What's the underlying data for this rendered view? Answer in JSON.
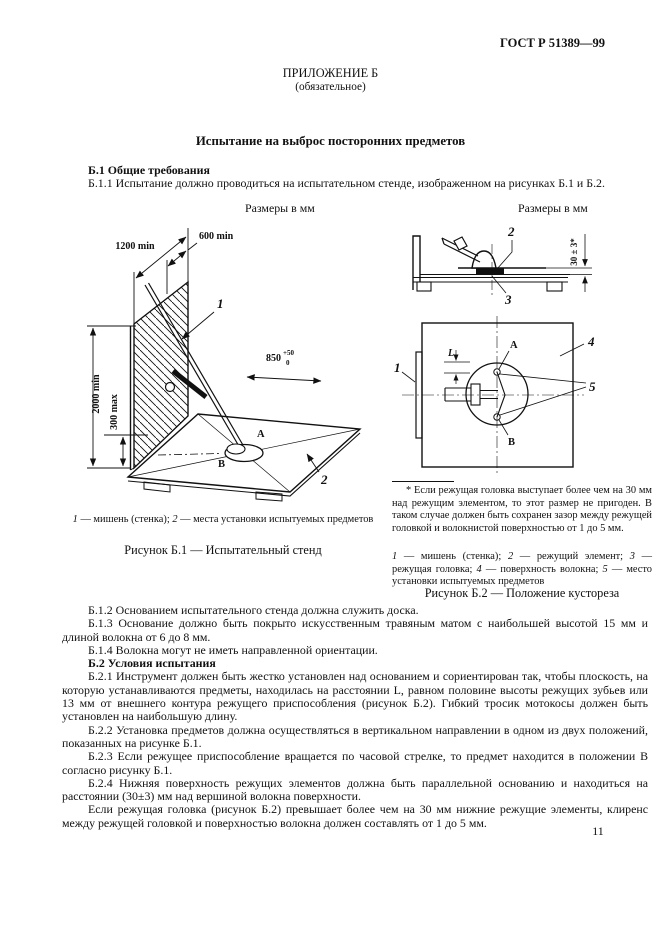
{
  "page": {
    "header_right": "ГОСТ Р 51389—99",
    "appendix_title": "ПРИЛОЖЕНИЕ Б",
    "appendix_subtitle": "(обязательное)",
    "main_title": "Испытание на выброс посторонних предметов",
    "page_number": "11"
  },
  "sizes_note": "Размеры в мм",
  "sections": {
    "b1_heading": "Б.1 Общие требования",
    "b11": "Б.1.1 Испытание должно проводиться на испытательном стенде, изображенном на рисунках Б.1 и Б.2.",
    "b12": "Б.1.2 Основанием испытательного стенда должна служить доска.",
    "b13": "Б.1.3 Основание должно быть покрыто искусственным травяным матом с наибольшей высотой 15 мм и длиной волокна от 6 до 8 мм.",
    "b14": "Б.1.4 Волокна могут не иметь направленной ориентации.",
    "b2_heading": "Б.2 Условия испытания",
    "b21": "Б.2.1 Инструмент должен быть жестко установлен над основанием и сориентирован так, чтобы плоскость, на которую устанавливаются предметы, находилась на расстоянии L, равном половине высоты режущих зубьев или 13 мм от внешнего контура режущего приспособления (рисунок Б.2). Гибкий тросик мотокосы должен быть установлен на наибольшую длину.",
    "b22": "Б.2.2 Установка предметов должна осуществляться в вертикальном направлении в одном из двух положений, показанных на рисунке Б.1.",
    "b23": "Б.2.3 Если режущее приспособление вращается по часовой стрелке, то предмет находится в положении В согласно рисунку Б.1.",
    "b24": "Б.2.4 Нижняя поверхность режущих элементов должна быть параллельной основанию и находиться на расстоянии (30±3) мм над вершиной волокна поверхности.",
    "b24_cont": "Если режущая головка (рисунок Б.2) превышает более чем на 30 мм нижние режущие элементы, клиренс между режущей головкой и поверхностью волокна должен составлять от 1 до 5 мм."
  },
  "figure_b1": {
    "dims": {
      "d1200": "1200 min",
      "d600": "600 min",
      "d2000": "2000 min",
      "d300": "300 max",
      "d850": "850",
      "d850_sup": "+50",
      "d850_sub": "0"
    },
    "callouts": {
      "c1": "1",
      "c2": "2",
      "a": "A",
      "b": "В"
    },
    "legend": [
      {
        "n": "1",
        "t": "мишень (стенка);"
      },
      {
        "n": "2",
        "t": "места установки испытуемых предметов"
      }
    ],
    "caption": "Рисунок Б.1 — Испытательный стенд"
  },
  "figure_b2": {
    "dims": {
      "d30": "30 ± 3*",
      "L": "L"
    },
    "callouts": {
      "c1": "1",
      "c2": "2",
      "c3": "3",
      "c4": "4",
      "c5": "5",
      "a": "A",
      "b": "В"
    },
    "footnote": "* Если режущая головка выступает более чем на 30 мм над режущим элементом, то этот размер не пригоден. В таком случае должен быть сохранен зазор между режущей головкой и волокнистой поверхностью от 1 до 5 мм.",
    "legend": [
      {
        "n": "1",
        "t": "мишень (стенка);"
      },
      {
        "n": "2",
        "t": "режущий элемент;"
      },
      {
        "n": "3",
        "t": "режущая головка;"
      },
      {
        "n": "4",
        "t": "поверхность волокна;"
      },
      {
        "n": "5",
        "t": "место установки испытуемых предметов"
      }
    ],
    "caption": "Рисунок Б.2 — Положение кустореза"
  }
}
